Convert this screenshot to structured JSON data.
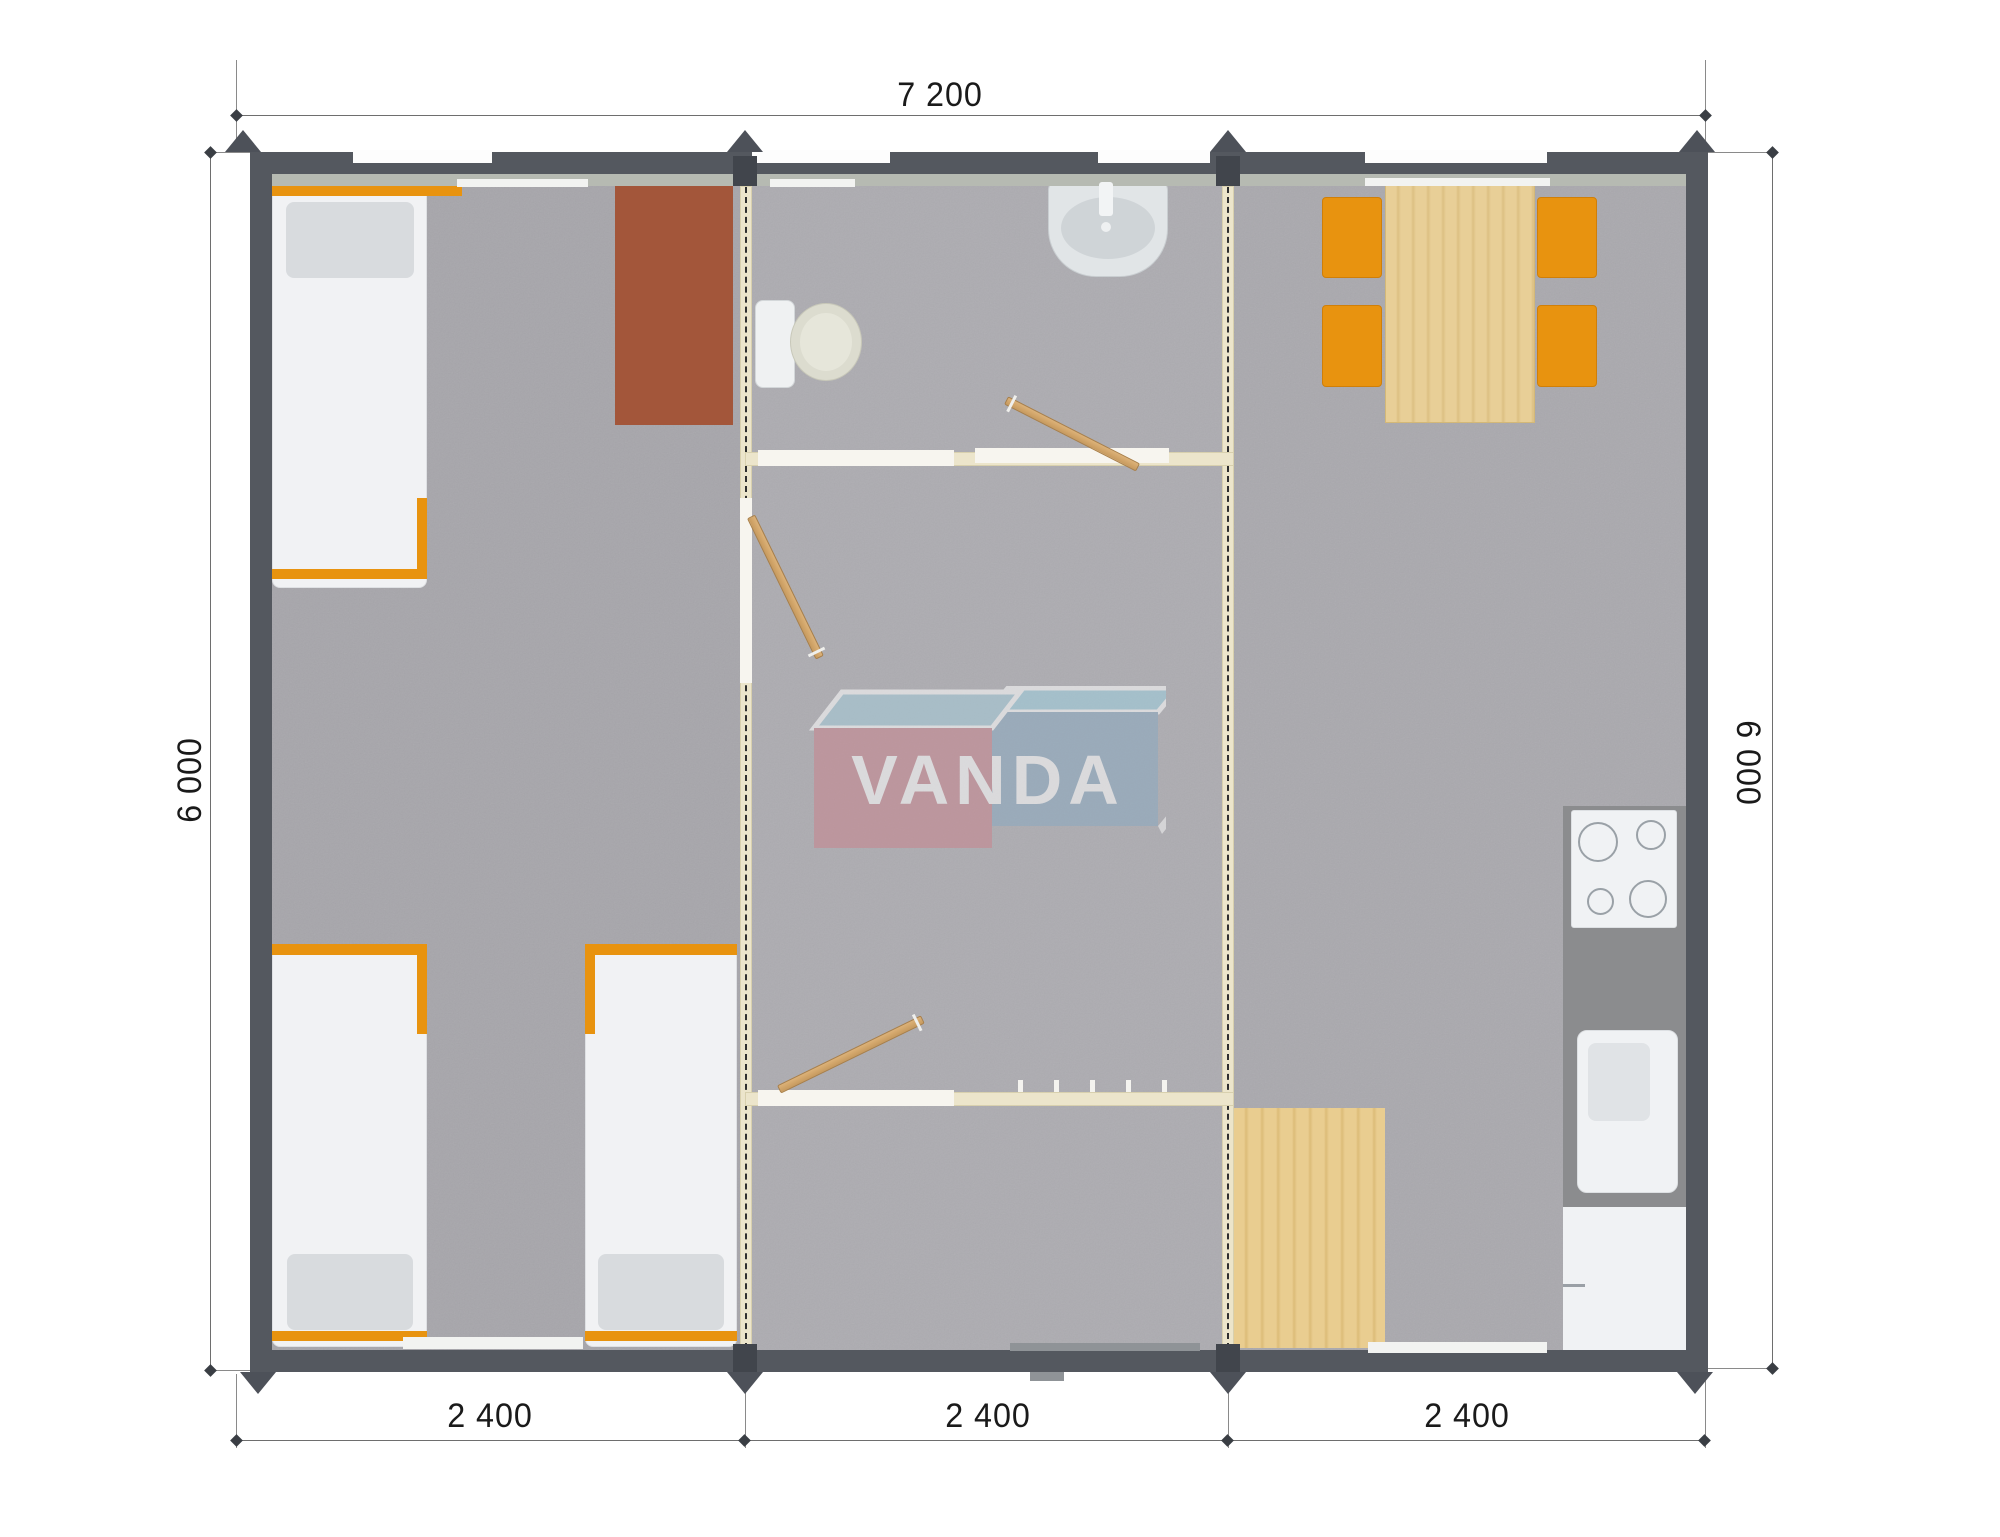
{
  "watermark": {
    "text": "VANDA",
    "box_left_color": "#c9858e",
    "box_right_color": "#8baac1",
    "box_top_color": "#a4cbd9"
  },
  "dimensions": {
    "overall_width": "7 200",
    "left_height": "6 000",
    "right_height": "6 000",
    "bottom_segments": [
      "2 400",
      "2 400",
      "2 400"
    ]
  },
  "colors": {
    "exterior_wall": "#54585f",
    "wall_inner_band": "#b6bab2",
    "floor_carpet": "#a9a8ac",
    "partition_cream": "#ece5cb",
    "accent_orange": "#e8930f",
    "desk_brown": "#a3563a",
    "wood_light": "#e6cb92",
    "counter_gray": "#8b8c8e",
    "fixture_white": "#f0f2f4"
  },
  "modules": [
    {
      "name": "bedroom-module",
      "furniture": [
        "single-bed",
        "single-bed",
        "single-bed",
        "desk"
      ]
    },
    {
      "name": "bathroom-hall-module",
      "furniture": [
        "toilet",
        "wash-basin",
        "door",
        "door",
        "door",
        "coat-hooks"
      ]
    },
    {
      "name": "kitchen-dining-module",
      "furniture": [
        "dining-table",
        "chair",
        "chair",
        "chair",
        "chair",
        "cooktop",
        "kitchen-sink",
        "cabinet",
        "floor-mat"
      ]
    }
  ]
}
